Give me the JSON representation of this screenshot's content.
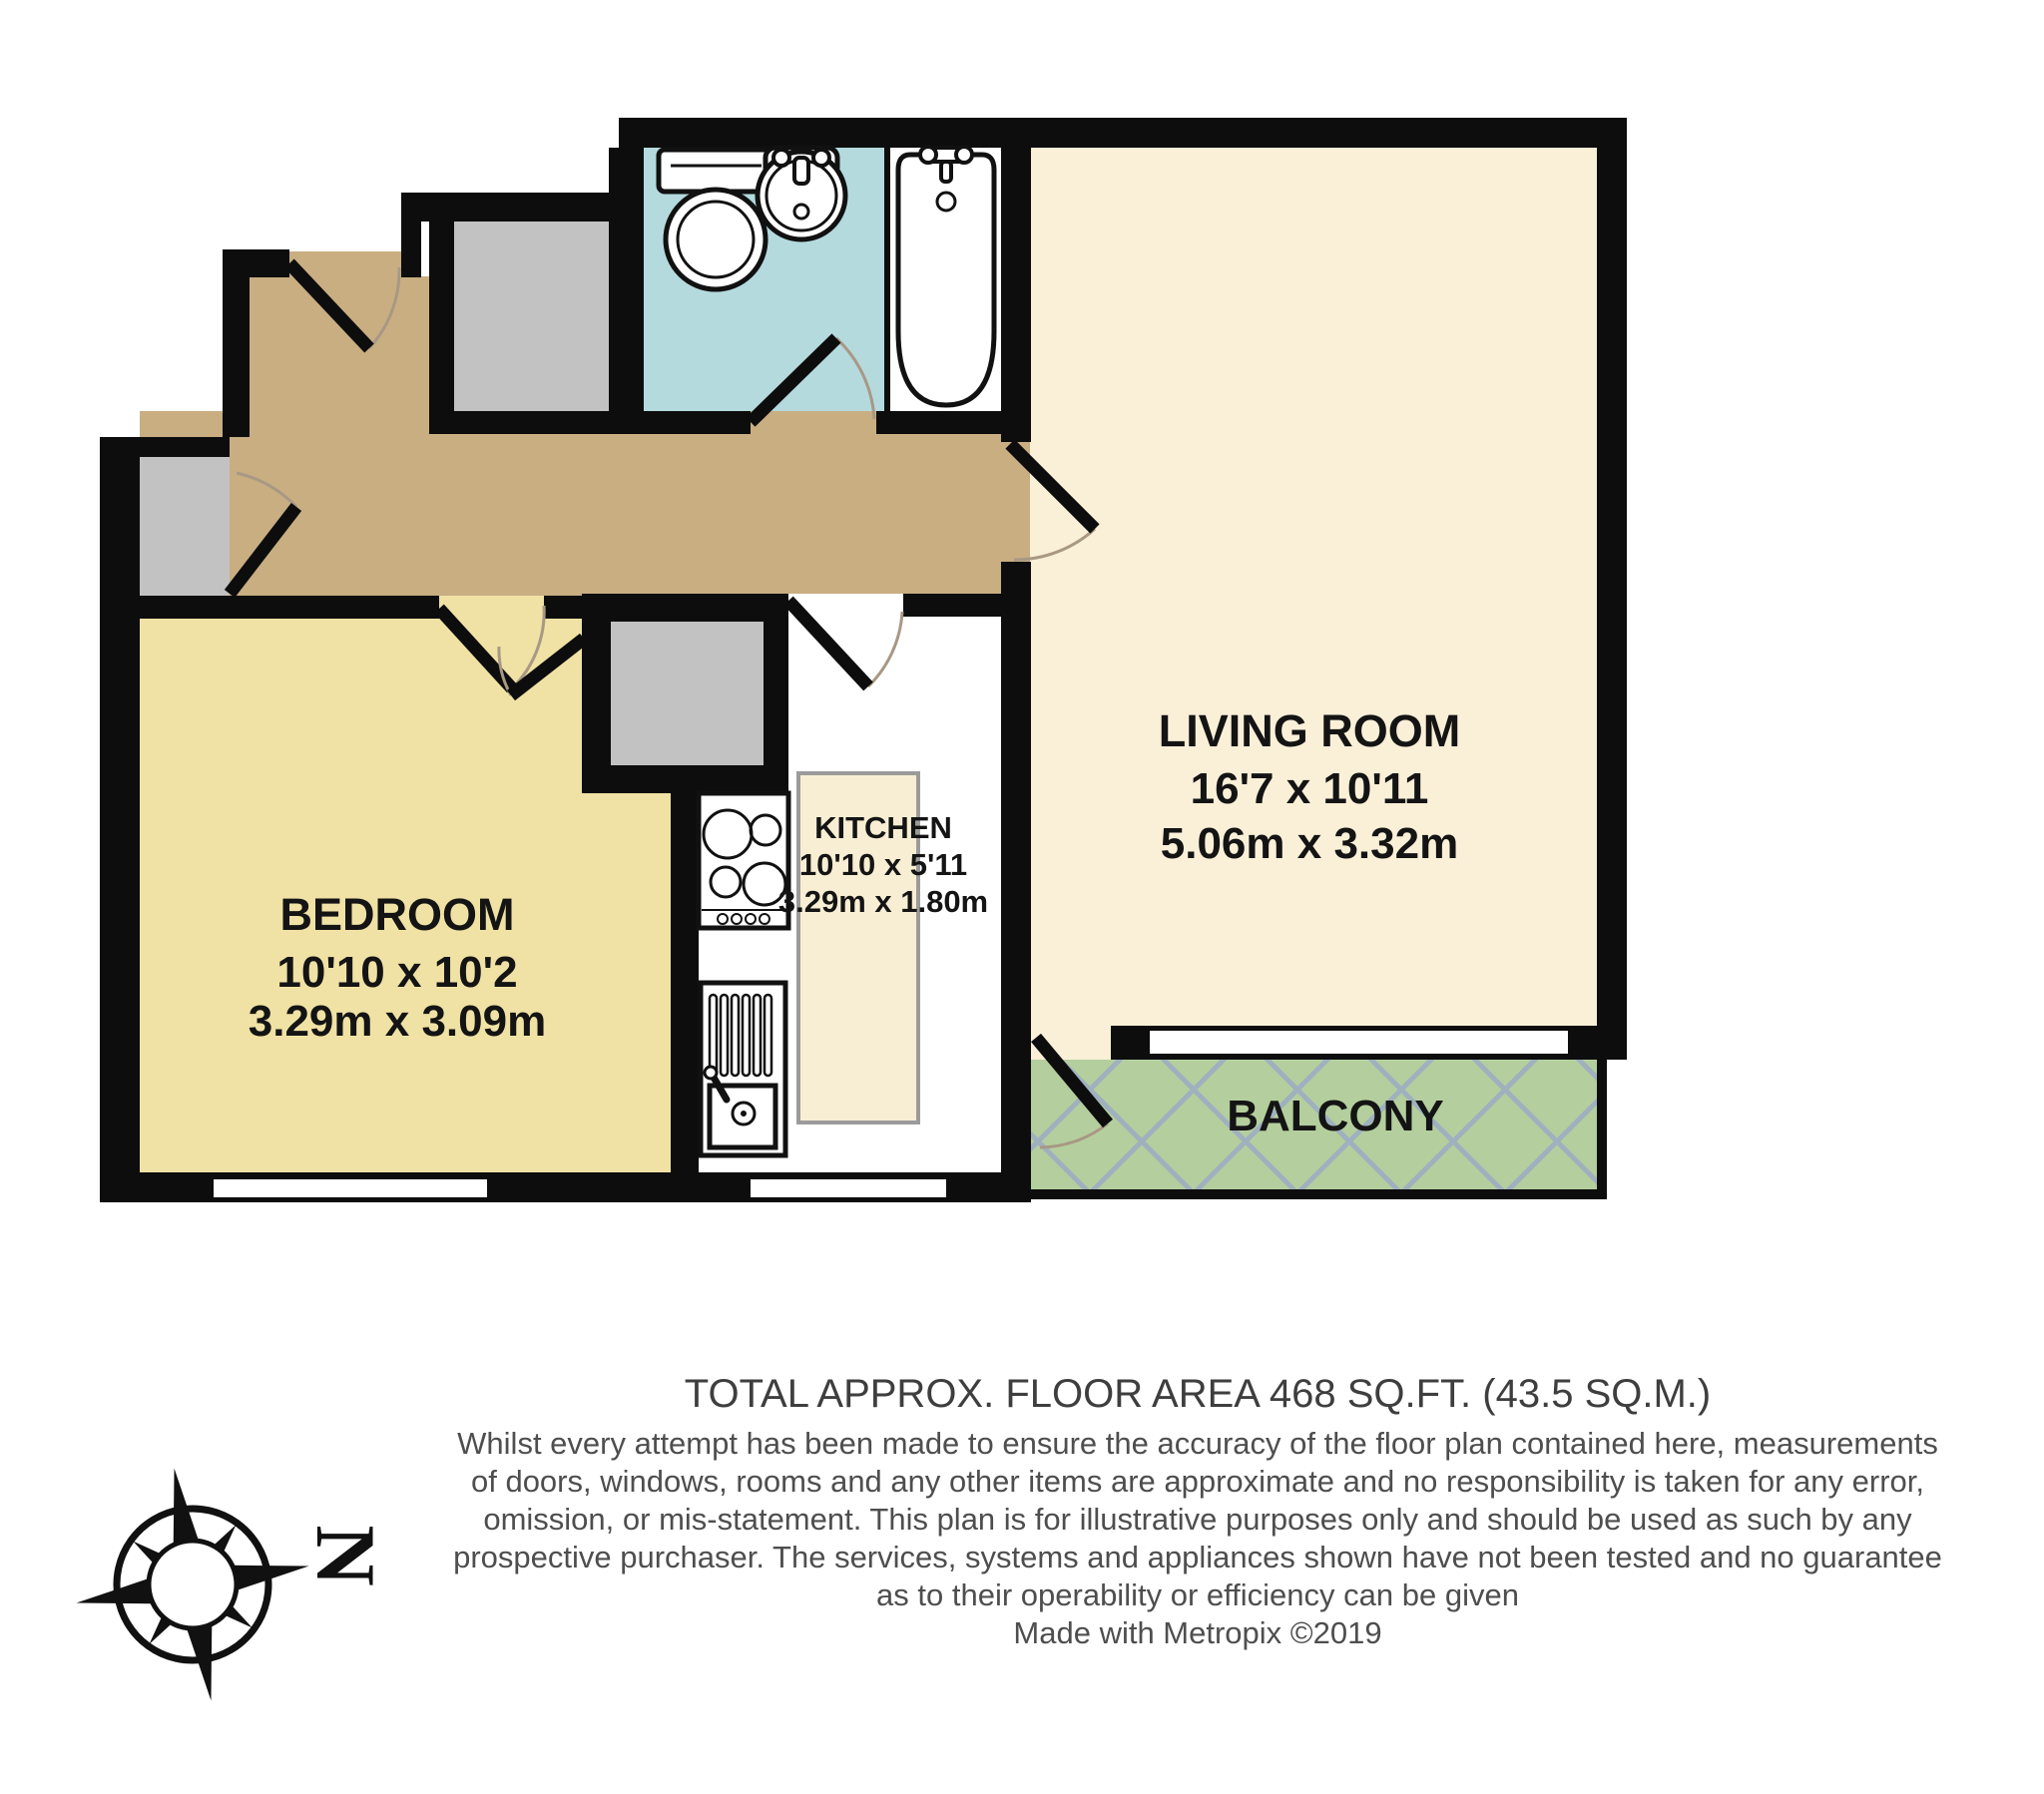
{
  "floor_plan": {
    "rooms": {
      "living_room": {
        "name": "LIVING ROOM",
        "dimensions_imperial": "16'7 x 10'11",
        "dimensions_metric": "5.06m x 3.32m"
      },
      "bedroom": {
        "name": "BEDROOM",
        "dimensions_imperial": "10'10 x 10'2",
        "dimensions_metric": "3.29m x 3.09m"
      },
      "kitchen": {
        "name": "KITCHEN",
        "dimensions_imperial": "10'10 x 5'11",
        "dimensions_metric": "3.29m x 1.80m"
      },
      "balcony": {
        "name": "BALCONY"
      }
    },
    "compass": {
      "north_label": "N"
    },
    "colors": {
      "wall": "#0d0d0d",
      "hallway": "#c9ae82",
      "bedroom": "#f0e2a4",
      "living_room": "#faf0d8",
      "kitchen": "#ffffff",
      "counter": "#f8eed3",
      "bathroom": "#b4dade",
      "balcony": "#b4cf9d",
      "balcony_hatch": "#9fb0bf",
      "closet": "#c2c2c2"
    }
  },
  "footer": {
    "title": "TOTAL APPROX. FLOOR AREA 468 SQ.FT. (43.5 SQ.M.)",
    "disclaimer_lines": [
      "Whilst every attempt has been made to ensure the accuracy of the floor plan contained here, measurements",
      "of doors, windows, rooms and any other items are approximate and no responsibility is taken for any error,",
      "omission, or mis-statement. This plan is for illustrative purposes only and should be used as such by any",
      "prospective purchaser. The services, systems and appliances shown have not been tested and no guarantee",
      "as to their operability or efficiency can be given"
    ],
    "credit": "Made with Metropix ©2019"
  }
}
